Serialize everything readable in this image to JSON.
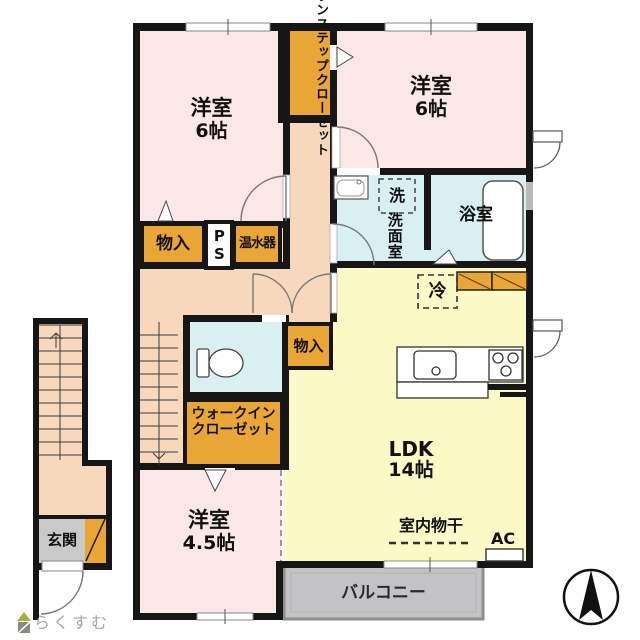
{
  "rooms": {
    "bedroom_nw": {
      "name": "洋室",
      "size": "6帖"
    },
    "bedroom_ne": {
      "name": "洋室",
      "size": "6帖"
    },
    "bedroom_s": {
      "name": "洋室",
      "size": "4.5帖"
    },
    "ldk": {
      "name": "LDK",
      "size": "14帖"
    },
    "bathroom": "浴室",
    "washroom": "洗面室",
    "entrance": "玄関",
    "balcony": "バルコニー"
  },
  "storage": {
    "one_step_closet": "ワンステップクローゼット",
    "storage_north": "物入",
    "storage_center": "物入",
    "walk_in_closet_line1": "ウォークイン",
    "walk_in_closet_line2": "クローゼット",
    "pipe_space": "PS",
    "water_heater": "温水器"
  },
  "fixtures": {
    "washing_machine": "洗",
    "refrigerator": "冷",
    "air_conditioner": "AC",
    "indoor_drying": "室内物干"
  },
  "watermark": "らくすむ",
  "colors": {
    "room_pink": "#fbe7e6",
    "corridor_peach": "#f8d8bc",
    "ldk_yellow": "#fbf9c6",
    "wet_cyan": "#d8f0f2",
    "closet_orange": "#e9a637",
    "entrance_gray": "#c9c9c9",
    "balcony_gray": "#c3c3c5",
    "wall_black": "#161616",
    "watermark_tan": "#b3a393"
  }
}
